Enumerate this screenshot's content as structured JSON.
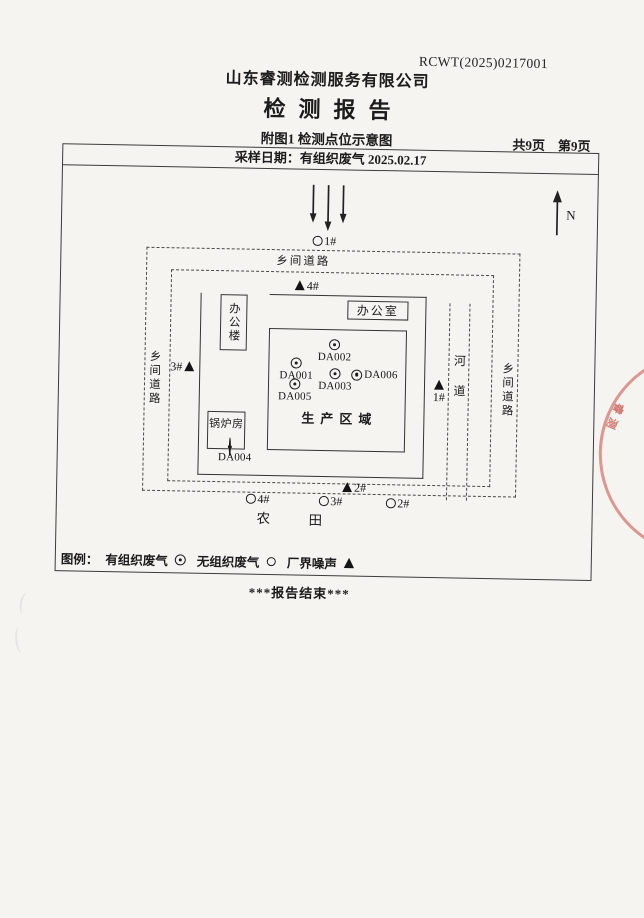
{
  "page": {
    "report_code": "RCWT(2025)0217001",
    "company_name": "山东睿测检测服务有限公司",
    "report_title": "检测报告",
    "figure_caption": "附图1 检测点位示意图",
    "pages_total": "共9页",
    "pages_current": "第9页",
    "sampling_line": "采样日期：有组织废气 2025.02.17",
    "end_text": "***报告结束***"
  },
  "diagram": {
    "north_label": "N",
    "road_top": "乡间道路",
    "road_left": "乡间道路",
    "road_right": "乡间道路",
    "river": "河道",
    "office_building": "办公楼",
    "office_room": "办公室",
    "boiler_room": "锅炉房",
    "production_area": "生产区域",
    "farmland_left": "农",
    "farmland_right": "田",
    "stack_points": {
      "da001": "DA001",
      "da002": "DA002",
      "da003": "DA003",
      "da004": "DA004",
      "da005": "DA005",
      "da006": "DA006"
    },
    "noise_points": {
      "top": "4#",
      "left": "3#",
      "right": "1#",
      "bottom": "2#"
    },
    "fugitive_points": {
      "top": "1#",
      "bottom_left": "4#",
      "bottom_mid": "3#",
      "bottom_right": "2#"
    }
  },
  "legend": {
    "label": "图例：",
    "organized": "有组织废气",
    "unorganized": "无组织废气",
    "noise": "厂界噪声",
    "symbols": {
      "organized": "◎",
      "unorganized": "○",
      "noise": "▲"
    }
  },
  "stamp": {
    "fragment_text": "睿测"
  },
  "colors": {
    "ink": "#1c1c1c",
    "line": "#3c3c3c",
    "stamp_red": "#c44a42",
    "paper": "#f5f4f0"
  }
}
